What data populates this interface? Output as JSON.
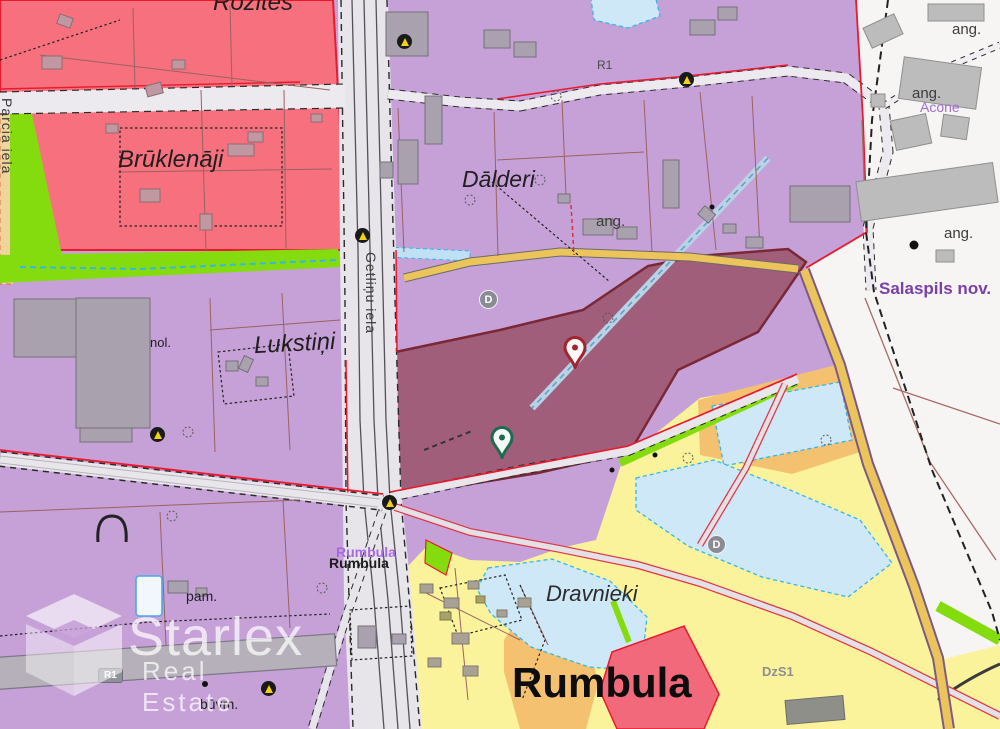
{
  "watermark": {
    "brand": "Starlex",
    "tagline": "Real Estate"
  },
  "places": {
    "rozites": "Rozītes",
    "bruklenaji": "Brūklenāji",
    "dalderi": "Dālderi",
    "lukstini": "Lukstiņi",
    "dravnieki": "Dravnieki",
    "rumbula_district": "Rumbula",
    "salaspils": "Salaspils nov.",
    "acone": "Acone"
  },
  "station": {
    "name": "Rumbula"
  },
  "streets": {
    "getlinu_iela": "Getliņu iela",
    "edge_street": "Parcia iela"
  },
  "small_labels": {
    "nol": "nol.",
    "pam": "pam.",
    "buvm": "būvm.",
    "ang": "ang.",
    "dzs1": "DzS1",
    "r1": "R1"
  },
  "markers": {
    "d_badge": "D"
  },
  "colors": {
    "zone_purple": "#c6a1d8",
    "zone_red": "#f7707e",
    "zone_selected_maroon": "#a05e7b",
    "zone_green": "#84dc0f",
    "zone_yellow": "#fbf39c",
    "zone_orange": "#f4c170",
    "water": "#cfe8f8",
    "white_area": "#f6f5f3",
    "red_boundary": "#ea1a2d",
    "parcel_line_brown": "#9b6161",
    "pin_red": "#a1242e",
    "pin_green": "#1e6b52",
    "label_purple": "#7b3fa8"
  }
}
